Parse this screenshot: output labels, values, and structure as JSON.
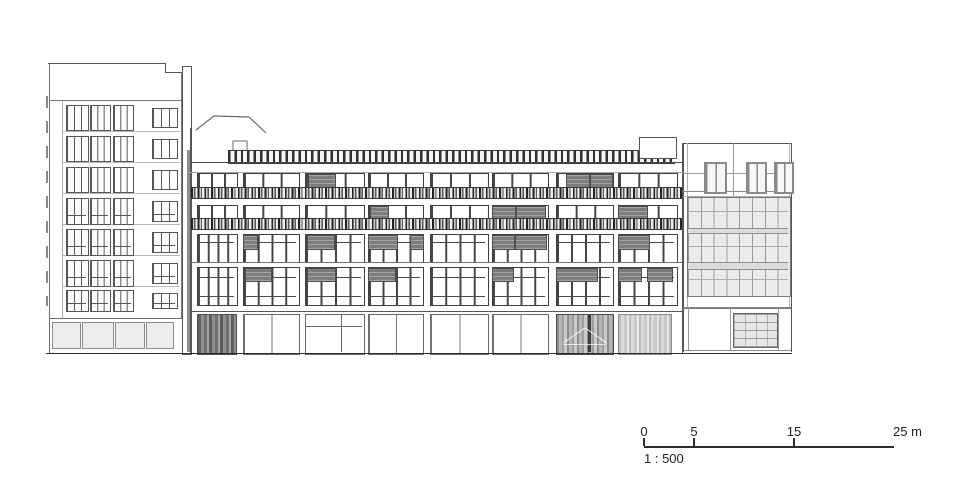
{
  "scale_bar": {
    "ratio": "1 : 500",
    "baseline": {
      "x": 644,
      "y": 445.5,
      "length": 250
    },
    "tick_height": 8,
    "ticks": [
      {
        "label": "0",
        "x": 644,
        "tick": true,
        "align": "center"
      },
      {
        "label": "5",
        "x": 694,
        "tick": true,
        "align": "center"
      },
      {
        "label": "15",
        "x": 794,
        "tick": true,
        "align": "center"
      },
      {
        "label": "25 m",
        "x": 893,
        "tick": false,
        "align": "left"
      }
    ]
  },
  "drawing": {
    "colors": {
      "line_dark": "#2d2d2d",
      "line": "#4a4a4a",
      "line_med": "#777777",
      "line_light": "#aaaaaa",
      "fill_light": "#ededed",
      "panel_dark": "#7d7d7d"
    },
    "ground_line": {
      "x": 46,
      "w": 746,
      "y": 352.6
    },
    "left_building": {
      "x": 49,
      "right": 182,
      "roof_y": 63,
      "step_x": 165,
      "step_y": 72,
      "dashed_x": 46,
      "inner_x": 62,
      "band_top_y": 100,
      "chimney": {
        "x": 182,
        "w": 7.5,
        "top": 66
      },
      "shadow": {
        "x": 186.8,
        "w": 3,
        "y": 150,
        "h": 202
      },
      "sill_lines": [
        131,
        162,
        193,
        224,
        255,
        286
      ],
      "rows": [
        {
          "y": 105,
          "h": 24,
          "t": false
        },
        {
          "y": 136,
          "h": 24,
          "t": false
        },
        {
          "y": 167,
          "h": 24,
          "t": false
        },
        {
          "y": 198,
          "h": 25,
          "t": true
        },
        {
          "y": 229,
          "h": 25,
          "t": true
        },
        {
          "y": 260,
          "h": 25,
          "t": true
        },
        {
          "y": 290,
          "h": 20,
          "t": true
        }
      ],
      "cols": [
        {
          "x": 66,
          "w": 21
        },
        {
          "x": 90,
          "w": 19
        },
        {
          "x": 113,
          "w": 19
        },
        {
          "x": 152,
          "w": 24,
          "inset": 3
        }
      ],
      "ground": {
        "line_y": 318,
        "box_y": 322,
        "box_h": 25,
        "boxes": [
          [
            52,
            27
          ],
          [
            82,
            30
          ],
          [
            115,
            28
          ],
          [
            146,
            26
          ]
        ]
      }
    },
    "center_building": {
      "x": 190,
      "right": 683,
      "penthouse": {
        "poly": [
          [
            6,
            22
          ],
          [
            24,
            8
          ],
          [
            59,
            9
          ],
          [
            76,
            25
          ]
        ],
        "box": [
          43,
          33,
          14,
          15
        ],
        "origin": [
          190,
          108
        ]
      },
      "pergola": {
        "x": 228,
        "right": 675,
        "y": 150,
        "h": 12
      },
      "roof_box": [
        639,
        137,
        36,
        20
      ],
      "roof_line_y": 162,
      "parapet_line_y": 171.5,
      "bays": [
        [
          197,
          39
        ],
        [
          243,
          55
        ],
        [
          305,
          58
        ],
        [
          368,
          54
        ],
        [
          430,
          57
        ],
        [
          492,
          55
        ],
        [
          556,
          56
        ],
        [
          618,
          58
        ]
      ],
      "floors": [
        {
          "y": 172.5,
          "h": 14,
          "lights": 3,
          "rail": {
            "y": 186.5,
            "h": 10.5
          },
          "darks": [
            [
              308,
              26
            ],
            [
              566,
              22
            ],
            [
              590,
              21
            ]
          ]
        },
        {
          "y": 204.5,
          "h": 14,
          "lights": 3,
          "rail": {
            "y": 218,
            "h": 10
          },
          "darks": [
            [
              370,
              17
            ],
            [
              492,
              22
            ],
            [
              516,
              28
            ],
            [
              618,
              28
            ]
          ]
        },
        {
          "y": 234,
          "h": 27,
          "lights": 4,
          "transoms": [
            7
          ],
          "line_y": 262,
          "dark_h": 13,
          "darks": [
            [
              243,
              13
            ],
            [
              307,
              26
            ],
            [
              368,
              28
            ],
            [
              410,
              12
            ],
            [
              492,
              21
            ],
            [
              515,
              30
            ],
            [
              618,
              30
            ]
          ]
        },
        {
          "y": 267,
          "h": 37,
          "lights": 4,
          "transoms": [
            9,
            28
          ],
          "line_y": 310.5,
          "dark_h": 12,
          "darks": [
            [
              245,
              25
            ],
            [
              307,
              27
            ],
            [
              368,
              26
            ],
            [
              492,
              20
            ],
            [
              556,
              40
            ],
            [
              618,
              22
            ],
            [
              647,
              24
            ]
          ]
        }
      ],
      "ground": {
        "top_line_y": 311,
        "y": 313.5,
        "h": 39,
        "bays": [
          {
            "x": 197,
            "w": 38,
            "type": "shutter_dark"
          },
          {
            "x": 243,
            "w": 55,
            "type": "glass",
            "lights": 2
          },
          {
            "x": 305,
            "w": 58,
            "type": "glass_cross"
          },
          {
            "x": 368,
            "w": 54,
            "type": "glass",
            "lights": 2
          },
          {
            "x": 430,
            "w": 57,
            "type": "glass",
            "lights": 2
          },
          {
            "x": 492,
            "w": 55,
            "type": "glass",
            "lights": 2
          },
          {
            "x": 556,
            "w": 56,
            "type": "gate"
          },
          {
            "x": 618,
            "w": 52,
            "type": "shutter_light"
          }
        ]
      }
    },
    "right_building": {
      "x": 683,
      "right": 791,
      "top_y": 143,
      "divider_x": 733,
      "attic_line_y": 173,
      "sill_y": 190.5,
      "sill_y2": 195.5,
      "small_windows": {
        "y": 161.5,
        "h": 28,
        "items": [
          [
            704,
            19
          ],
          [
            746,
            17
          ],
          [
            774,
            16
          ]
        ]
      },
      "curtain": {
        "x": 687,
        "y": 197,
        "w": 102,
        "h": 98,
        "thin_lines": [
          210,
          245,
          278
        ],
        "spandrels": [
          [
            227,
            4
          ],
          [
            261,
            6
          ]
        ]
      },
      "parapet_line_y": 306.5,
      "ground": {
        "top": 307.5,
        "door": [
          733,
          313,
          43,
          33
        ],
        "posts": [
          687.5,
          730,
          777.5
        ],
        "base": 349.5
      }
    }
  }
}
